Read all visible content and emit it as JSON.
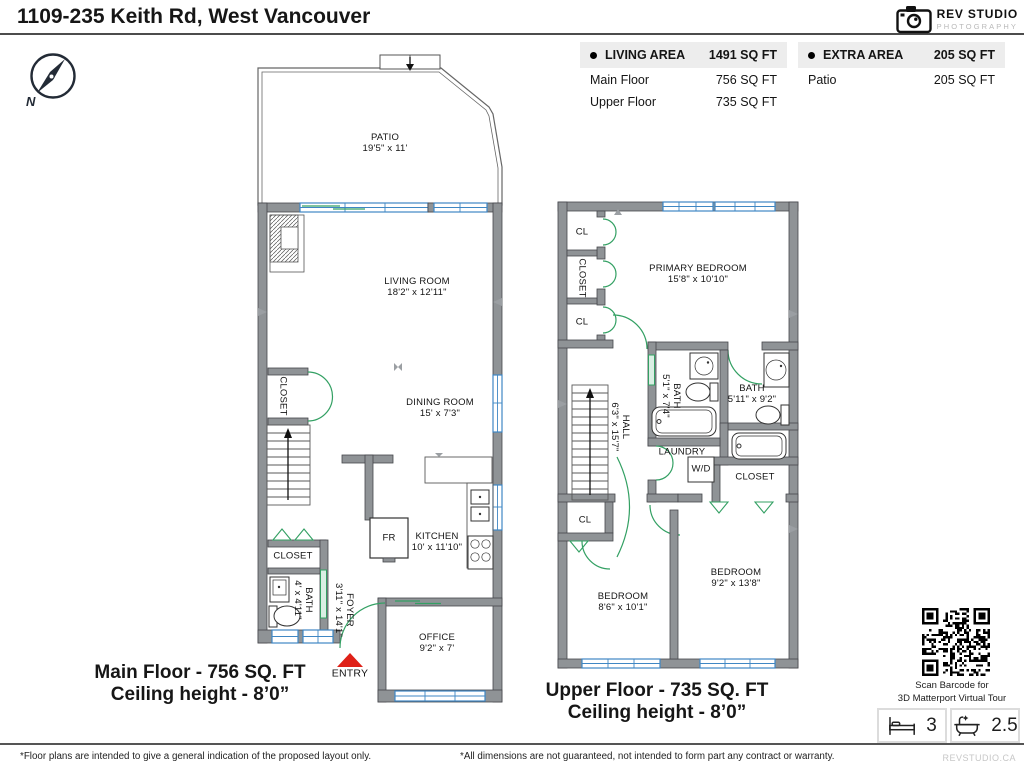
{
  "title": "1109-235 Keith Rd, West Vancouver",
  "logo": {
    "name": "REV STUDIO",
    "sub": "PHOTOGRAPHY"
  },
  "compass": {
    "north": "N"
  },
  "area_tables": {
    "living": {
      "label": "LIVING AREA",
      "total": "1491 SQ FT",
      "rows": [
        {
          "name": "Main Floor",
          "value": "756 SQ FT"
        },
        {
          "name": "Upper Floor",
          "value": "735 SQ FT"
        }
      ]
    },
    "extra": {
      "label": "EXTRA AREA",
      "total": "205 SQ FT",
      "rows": [
        {
          "name": "Patio",
          "value": "205 SQ FT"
        }
      ]
    }
  },
  "main_floor": {
    "caption": {
      "line1": "Main Floor - 756 SQ. FT",
      "line2": "Ceiling height - 8’0”"
    },
    "entry": "ENTRY",
    "rooms": {
      "patio": {
        "name": "PATIO",
        "dims": "19'5\" x 11'"
      },
      "living": {
        "name": "LIVING ROOM",
        "dims": "18'2\" x 12'11\""
      },
      "dining": {
        "name": "DINING ROOM",
        "dims": "15' x 7'3\""
      },
      "kitchen": {
        "name": "KITCHEN",
        "dims": "10' x 11'10\""
      },
      "office": {
        "name": "OFFICE",
        "dims": "9'2\" x 7'"
      },
      "bath": {
        "name": "BATH",
        "dims": "4' x 4'11\""
      },
      "foyer": {
        "name": "FOYER",
        "dims": "3'11\" x 14'1\""
      },
      "closet_upper": "CLOSET",
      "closet_lower": "CLOSET",
      "fridge": "FR"
    }
  },
  "upper_floor": {
    "caption": {
      "line1": "Upper Floor - 735 SQ. FT",
      "line2": "Ceiling height - 8’0”"
    },
    "rooms": {
      "primary": {
        "name": "PRIMARY BEDROOM",
        "dims": "15'8\" x 10'10\""
      },
      "bath1": {
        "name": "BATH",
        "dims": "5'1\" x 7'4\""
      },
      "bath2": {
        "name": "BATH",
        "dims": "5'11\" x 9'2\""
      },
      "hall": {
        "name": "HALL",
        "dims": "6'3\" x 15'7\""
      },
      "bedroom1": {
        "name": "BEDROOM",
        "dims": "8'6\" x 10'1\""
      },
      "bedroom2": {
        "name": "BEDROOM",
        "dims": "9'2\" x 13'8\""
      },
      "laundry": "LAUNDRY",
      "wd": "W/D",
      "closet": "CLOSET",
      "closet_vert": "CLOSET",
      "cl1": "CL",
      "cl2": "CL",
      "cl3": "CL"
    }
  },
  "qr": {
    "line1": "Scan Barcode for",
    "line2": "3D Matterport Virtual Tour"
  },
  "stats": {
    "beds": "3",
    "baths": "2.5"
  },
  "footer": {
    "left": "*Floor plans are intended to give a general indication of the proposed layout only.",
    "center": "*All dimensions are not guaranteed, not intended to form part any contract or warranty.",
    "brand": "REVSTUDIO.CA"
  },
  "colors": {
    "wall": "#8f9396",
    "window": "#3f87c4",
    "door": "#33a063",
    "entry": "#df2118",
    "table_header_bg": "#ededed",
    "brand_gray": "#b9b9b9"
  }
}
